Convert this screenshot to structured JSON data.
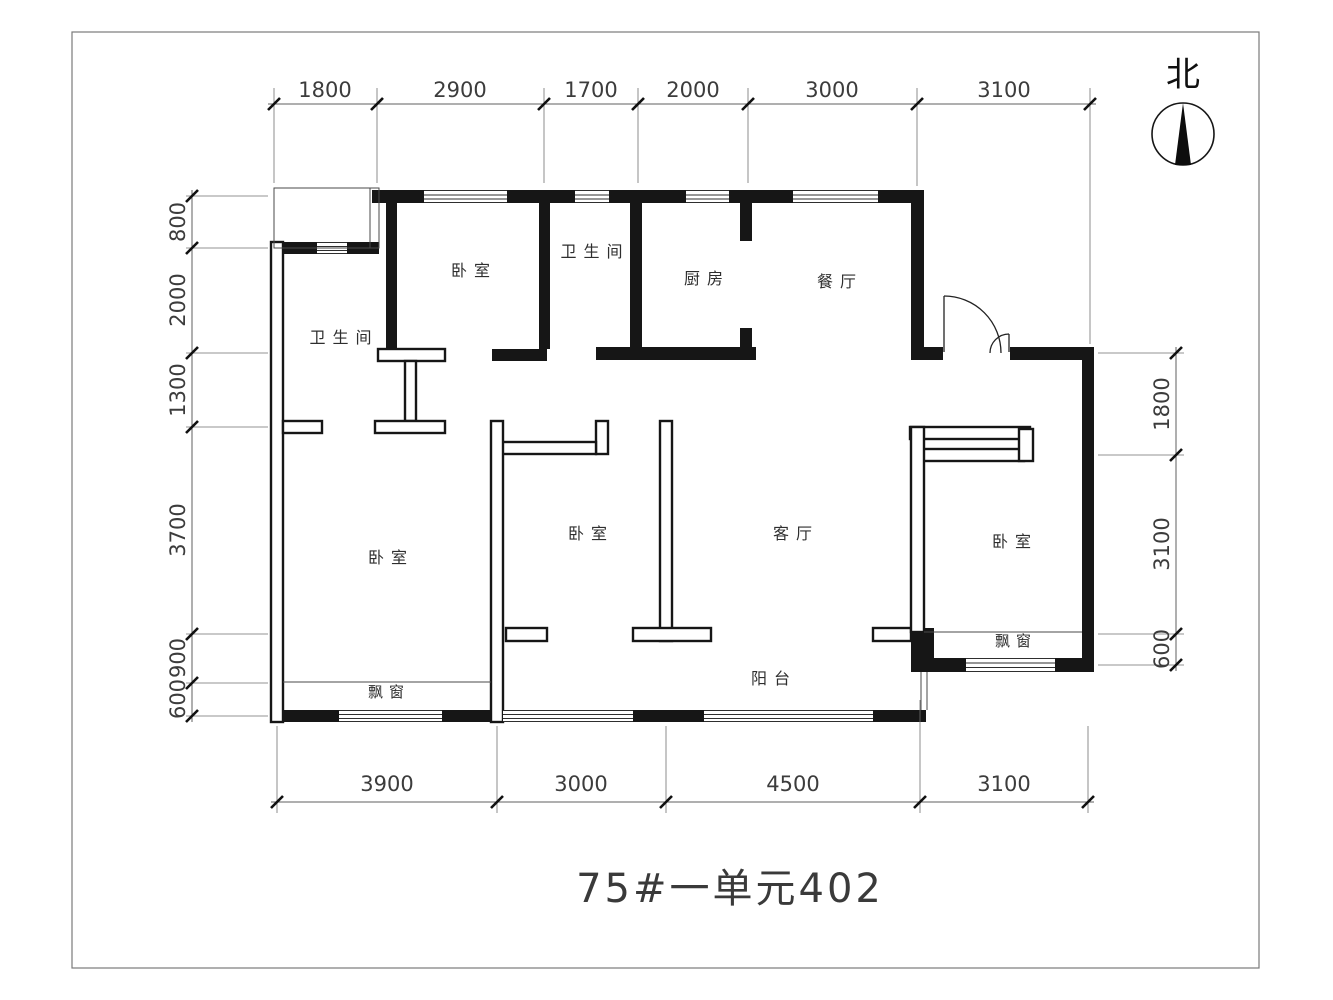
{
  "title": "75#一单元402",
  "north": {
    "label": "北"
  },
  "rooms": {
    "bathroom_left": "卫生间",
    "bedroom_top": "卧室",
    "bathroom_top": "卫生间",
    "kitchen": "厨房",
    "dining": "餐厅",
    "bedroom_left": "卧室",
    "bedroom_middle": "卧室",
    "living": "客厅",
    "bedroom_right": "卧室",
    "balcony": "阳台",
    "bay_window_left": "飘窗",
    "bay_window_right": "飘窗"
  },
  "dimensions": {
    "top": [
      "1800",
      "2900",
      "1700",
      "2000",
      "3000",
      "3100"
    ],
    "bottom": [
      "3900",
      "3000",
      "4500",
      "3100"
    ],
    "left": [
      "800",
      "2000",
      "1300",
      "3700",
      "900",
      "600"
    ],
    "right": [
      "1800",
      "3100",
      "600"
    ]
  },
  "colors": {
    "wall": "#161616",
    "dimension_line": "#5f5f5f",
    "text": "#3c3c3c",
    "background": "#ffffff"
  }
}
